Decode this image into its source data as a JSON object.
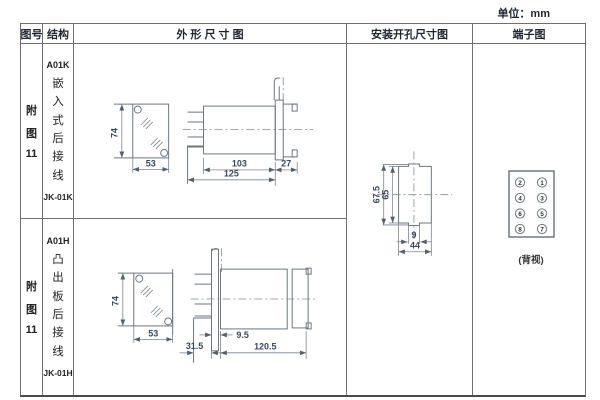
{
  "unit_label": "单位：mm",
  "headers": {
    "fig_no": "图号",
    "structure": "结构",
    "outline": "外 形 尺 寸 图",
    "mounting": "安装开孔尺寸图",
    "terminal": "端子图"
  },
  "rows": [
    {
      "fig_chars": [
        "附",
        "图",
        "11"
      ],
      "model": "A01K",
      "mount_type": "嵌入式后接线",
      "code": "JK-01K",
      "dims": {
        "front_height": "74",
        "front_width": "53",
        "body_length": "103",
        "flange_depth": "27",
        "total_length": "125"
      }
    },
    {
      "fig_chars": [
        "附",
        "图",
        "11"
      ],
      "model": "A01H",
      "mount_type": "凸出板后接线",
      "code": "JK-01H",
      "dims": {
        "front_height": "74",
        "front_width": "53",
        "board_offset": "9.5",
        "pin_length": "31.5",
        "body_length": "120.5"
      }
    }
  ],
  "mounting_dims": {
    "outer_height": "67.5",
    "cutout_height": "65",
    "slot_width": "9",
    "cutout_width": "44"
  },
  "terminal": {
    "pins": [
      "2",
      "1",
      "4",
      "3",
      "6",
      "5",
      "8",
      "7"
    ],
    "view_label": "(背视)"
  }
}
